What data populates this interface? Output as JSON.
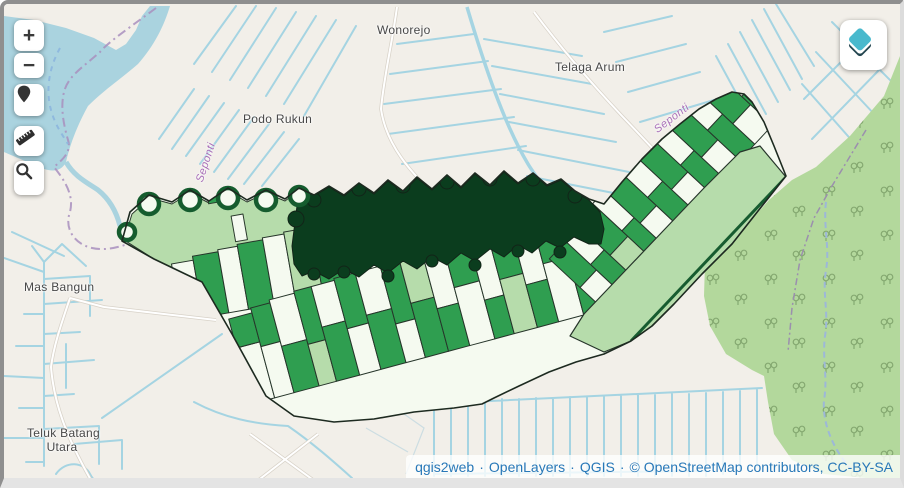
{
  "map": {
    "labels": {
      "wonorejo": "Wonorejo",
      "telaga_arum": "Telaga Arum",
      "podo_rukun": "Podo Rukun",
      "mas_bangun": "Mas Bangun",
      "teluk_batang_1": "Teluk Batang",
      "teluk_batang_2": "Utara",
      "river_west": "Seponti",
      "river_east": "Seponti"
    }
  },
  "controls": {
    "zoom_in": "+",
    "zoom_out": "−",
    "icons": [
      "marker-icon",
      "ruler-icon",
      "search-icon",
      "layers-icon"
    ]
  },
  "attribution": {
    "parts": [
      "qgis2web",
      "OpenLayers",
      "QGIS",
      "© OpenStreetMap contributors, CC-BY-SA"
    ],
    "separator": "·"
  },
  "colors": {
    "basemap": "#f2efe9",
    "water": "#aad3df",
    "scrub": "#b3d89c",
    "choropleth_classes": [
      "#f5faf0",
      "#b6dcab",
      "#2f9e50",
      "#0b3d1e"
    ],
    "attribution_link": "#2878b8",
    "layers_icon": "#49b9cd"
  }
}
